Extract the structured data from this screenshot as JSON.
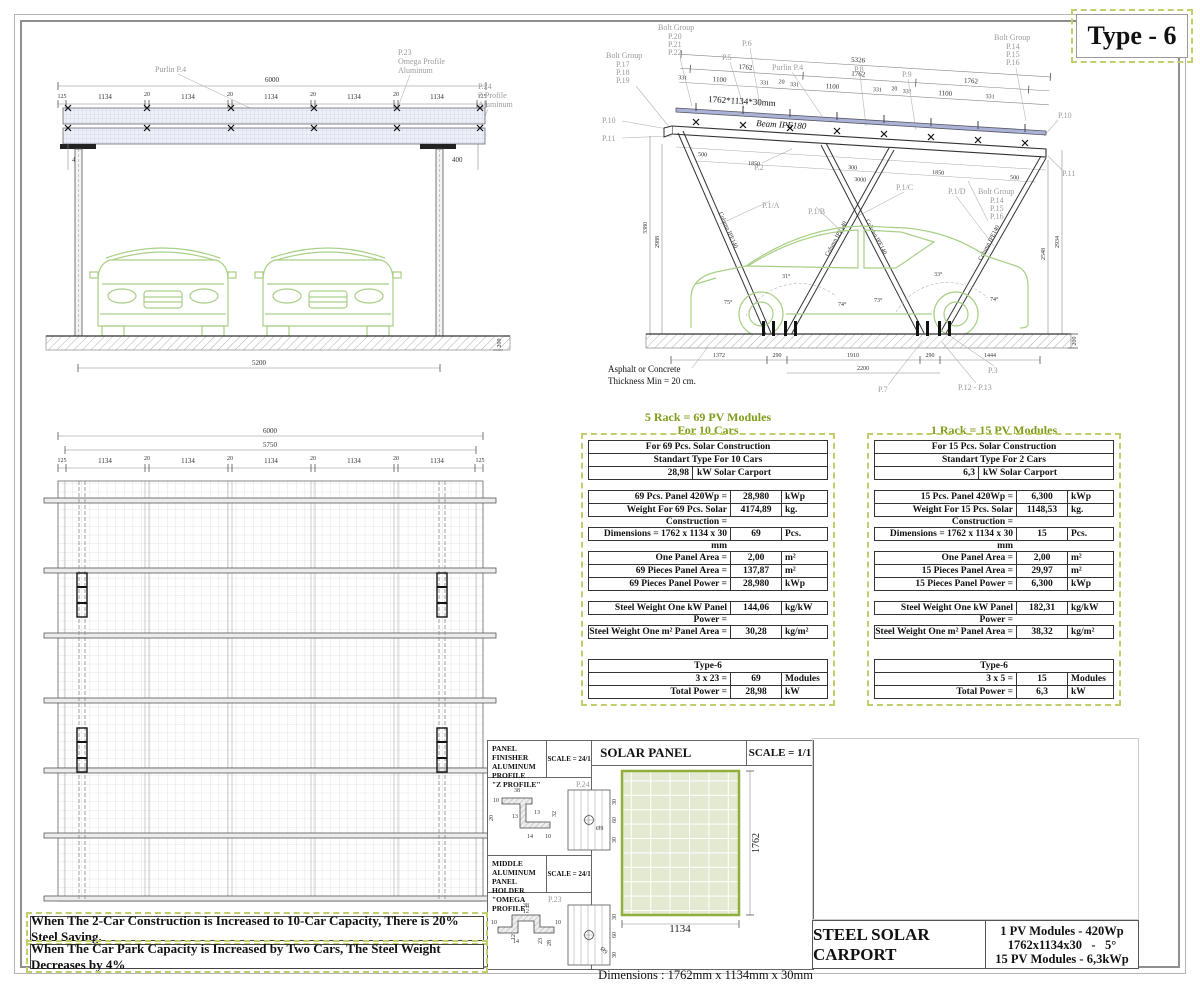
{
  "page": {
    "type_title": "Type - 6"
  },
  "front": {
    "d6000": "6000",
    "d125": "125",
    "d1134": "1134",
    "d20": "20",
    "d400": "400",
    "d5200": "5200",
    "d200": "200",
    "purlin": "Purlin P.4",
    "p23": "P.23",
    "p23a": "Omega Profile",
    "p23b": "Aluminum",
    "p24": "P.24",
    "p24a": "Z Profile",
    "p24b": "Aluminum"
  },
  "side": {
    "bolt_group": "Bolt Group",
    "bg1": [
      "P.17",
      "P.18",
      "P.19"
    ],
    "bg2": [
      "P.20",
      "P.21",
      "P.22"
    ],
    "bg3": [
      "P.14",
      "P.15",
      "P.16"
    ],
    "p5": "P.5",
    "p6": "P.6",
    "purlin": "Purlin P.4",
    "p8": "P.8",
    "p9": "P.9",
    "p10": "P.10",
    "p11": "P.11",
    "p2": "P.2",
    "p1a": "P.1/A",
    "p1b": "P.1/B",
    "p1c": "P.1/C",
    "p1d": "P.1/D",
    "p7": "P.7",
    "p3": "P.3",
    "p1213": "P.12 - P.13",
    "beam": "Beam IPE180",
    "column": "Column IPE140",
    "panel_size": "1762*1134*30mm",
    "d5326": "5326",
    "d1762": "1762",
    "d1100": "1100",
    "d331": "331",
    "d20": "20",
    "d500": "500",
    "d1850": "1850",
    "d300": "300",
    "d3000": "3000",
    "v3380": "3380",
    "v2988": "2988",
    "v2548": "2548",
    "v2934": "2934",
    "d200": "200",
    "g1372": "1372",
    "g290": "290",
    "g1910": "1910",
    "g1444": "1444",
    "g2200": "2200",
    "a31": "31°",
    "a33": "33°",
    "a75": "75°",
    "a74": "74°",
    "a73": "73°",
    "ground1": "Asphalt or Concrete",
    "ground2": "Thickness Min = 20 cm."
  },
  "plan": {
    "d6000": "6000",
    "d5750": "5750",
    "d125": "125",
    "d1134": "1134",
    "d20": "20"
  },
  "tables": [
    {
      "title_lines": [
        "5 Rack = 69 PV Modules",
        "For 10 Cars"
      ],
      "groups": [
        {
          "rows": [
            {
              "t": "full",
              "c": "For 69 Pcs. Solar Construction"
            },
            {
              "t": "full",
              "c": "Standart Type For 10 Cars"
            },
            {
              "t": "split",
              "a": "28,98",
              "b": "kW Solar Carport"
            }
          ]
        },
        {
          "rows": [
            {
              "t": "lvu",
              "l": "69 Pcs. Panel 420Wp =",
              "v": "28,980",
              "u": "kWp"
            },
            {
              "t": "lvu",
              "l": "Weight For 69 Pcs. Solar Construction =",
              "v": "4174,89",
              "u": "kg."
            }
          ]
        },
        {
          "rows": [
            {
              "t": "lvu",
              "l": "Dimensions = 1762 x 1134 x 30 mm",
              "v": "69",
              "u": "Pcs."
            }
          ]
        },
        {
          "rows": [
            {
              "t": "lvu",
              "l": "One Panel Area =",
              "v": "2,00",
              "u": "m²"
            },
            {
              "t": "lvu",
              "l": "69 Pieces Panel Area =",
              "v": "137,87",
              "u": "m²"
            },
            {
              "t": "lvu",
              "l": "69 Pieces Panel Power =",
              "v": "28,980",
              "u": "kWp"
            }
          ]
        },
        {
          "rows": [
            {
              "t": "lvu",
              "l": "Steel Weight One kW Panel Power =",
              "v": "144,06",
              "u": "kg/kW"
            }
          ]
        },
        {
          "rows": [
            {
              "t": "lvu",
              "l": "Steel Weight One m² Panel Area =",
              "v": "30,28",
              "u": "kg/m²"
            }
          ]
        },
        {
          "rows": [
            {
              "t": "full",
              "c": "Type-6"
            },
            {
              "t": "lvu",
              "l": "3 x 23 =",
              "v": "69",
              "u": "Modules"
            },
            {
              "t": "lvu",
              "l": "Total Power =",
              "v": "28,98",
              "u": "kW"
            }
          ]
        }
      ]
    },
    {
      "title_lines": [
        "1 Rack = 15 PV Modules"
      ],
      "groups": [
        {
          "rows": [
            {
              "t": "full",
              "c": "For 15 Pcs. Solar Construction"
            },
            {
              "t": "full",
              "c": "Standart Type For 2 Cars"
            },
            {
              "t": "split",
              "a": "6,3",
              "b": "kW Solar Carport"
            }
          ]
        },
        {
          "rows": [
            {
              "t": "lvu",
              "l": "15 Pcs. Panel 420Wp =",
              "v": "6,300",
              "u": "kWp"
            },
            {
              "t": "lvu",
              "l": "Weight For 15 Pcs. Solar Construction =",
              "v": "1148,53",
              "u": "kg."
            }
          ]
        },
        {
          "rows": [
            {
              "t": "lvu",
              "l": "Dimensions = 1762 x 1134 x 30 mm",
              "v": "15",
              "u": "Pcs."
            }
          ]
        },
        {
          "rows": [
            {
              "t": "lvu",
              "l": "One Panel Area =",
              "v": "2,00",
              "u": "m²"
            },
            {
              "t": "lvu",
              "l": "15 Pieces Panel Area =",
              "v": "29,97",
              "u": "m²"
            },
            {
              "t": "lvu",
              "l": "15 Pieces Panel Power =",
              "v": "6,300",
              "u": "kWp"
            }
          ]
        },
        {
          "rows": [
            {
              "t": "lvu",
              "l": "Steel Weight One kW Panel Power =",
              "v": "182,31",
              "u": "kg/kW"
            }
          ]
        },
        {
          "rows": [
            {
              "t": "lvu",
              "l": "Steel Weight One m² Panel Area =",
              "v": "38,32",
              "u": "kg/m²"
            }
          ]
        },
        {
          "rows": [
            {
              "t": "full",
              "c": "Type-6"
            },
            {
              "t": "lvu",
              "l": "3 x 5 =",
              "v": "15",
              "u": "Modules"
            },
            {
              "t": "lvu",
              "l": "Total Power =",
              "v": "6,3",
              "u": "kW"
            }
          ]
        }
      ]
    }
  ],
  "details": {
    "z": {
      "t1": "PANEL FINISHER",
      "t2": "ALUMINUM PROFILE",
      "t3": "\"Z PROFILE\"",
      "scale": "SCALE = 24/1",
      "ref": "P.24",
      "d38": "38",
      "d10": "10",
      "d13": "13",
      "d20": "20",
      "d32": "32",
      "d14": "14",
      "d30": "30",
      "d60": "60",
      "hole": "Ø9"
    },
    "o": {
      "t1": "MIDDLE ALUMINUM",
      "t2": "PANEL HOLDER",
      "t3": "\"OMEGA PROFILE\"",
      "scale": "SCALE = 24/1",
      "ref": "P.23",
      "d38": "38",
      "d12": "12",
      "d10": "10",
      "d23": "23",
      "d28": "28",
      "d14": "14",
      "d30": "30",
      "d60": "60",
      "hole": "Ø9"
    },
    "sp": {
      "title": "SOLAR PANEL",
      "scale": "SCALE = 1/1",
      "h": "1762",
      "w": "1134",
      "dims": "Dimensions : 1762mm x 1134mm x 30mm",
      "weight": "Weight        : 25kg"
    }
  },
  "banners": {
    "line1": "When The 2-Car Construction is Increased to 10-Car Capacity, There is 20% Steel Saving.",
    "line2": "When The Car Park Capacity is Increased by Two Cars, The Steel Weight Decreases by 4%"
  },
  "title_block": {
    "name": "STEEL SOLAR CARPORT",
    "l1": "1 PV Modules - 420Wp",
    "l2": "1762x1134x30   -   5°",
    "l3": "15 PV Modules - 6,3kWp"
  }
}
